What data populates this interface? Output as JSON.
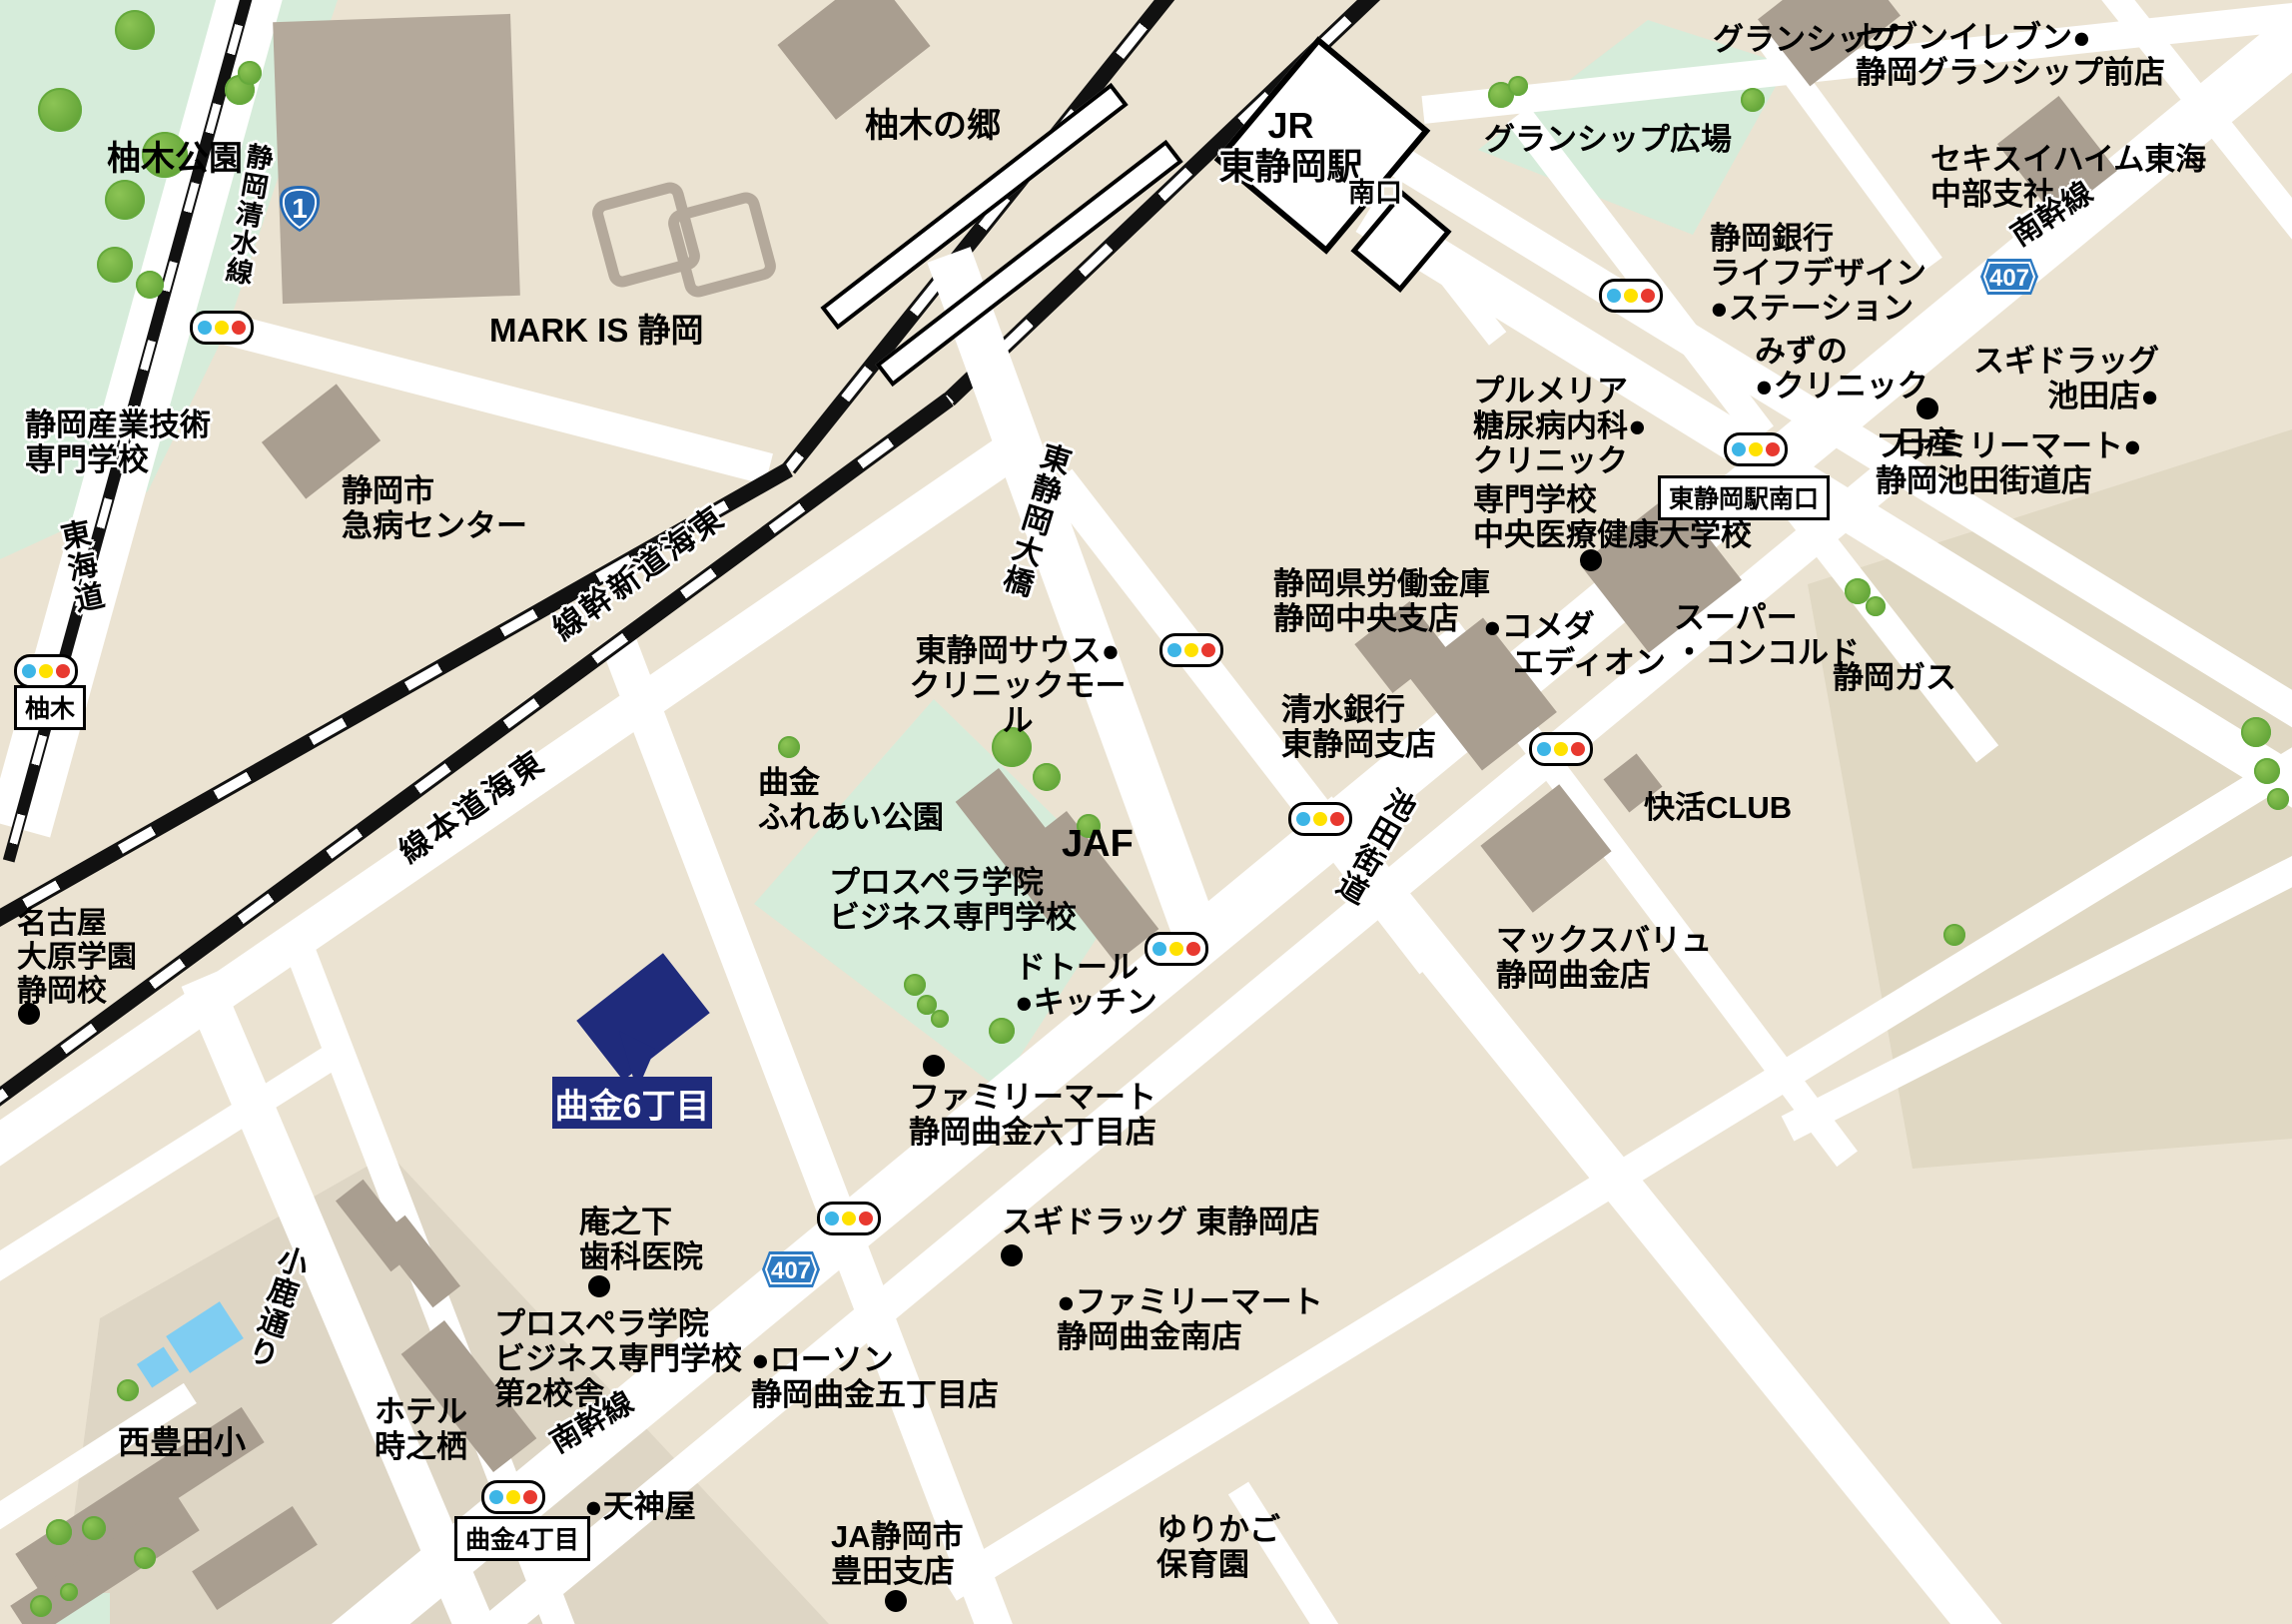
{
  "map_title": "東静岡駅周辺アクセスマップ",
  "colors": {
    "background": "#ebe3d2",
    "road": "#ffffff",
    "rail": "#111111",
    "park": "#d6ecda",
    "school_block": "#ded6c5",
    "gas_block": "#e0d8c3",
    "building": "#b4a99b",
    "building_dark": "#a99e90",
    "pool": "#7fcdf2",
    "highlight_navy": "#1f2b7c",
    "badge_blue": "#2569b4",
    "badge_blue_407": "#2d7ac2",
    "signal_blue": "#3db5e6",
    "signal_yellow": "#ffe100",
    "signal_red": "#e8392f"
  },
  "labels": {
    "route1": "1",
    "route407": "407",
    "yunoki_park": "柚木公園",
    "shimizu_line": "静岡清水線",
    "sangyo_tech": "静岡産業技術\n専門学校",
    "tokaido": "東海道",
    "yunoki_box": "柚木",
    "mark_is": "MARK IS 静岡",
    "kyubyo_center": "静岡市\n急病センター",
    "yunokinosato": "柚木の郷",
    "jr_station": "JR\n東静岡駅",
    "minamiguchi": "南口",
    "granship": "グランシップ",
    "seven_eleven": "セブンイレブン●\n静岡グランシップ前店",
    "granship_plaza": "グランシップ広場",
    "sekisui_heim": "セキスイハイム東海\n中部支社",
    "nankansen_top": "南幹線",
    "shizuoka_bank": "静岡銀行\nライフデザイン\n●ステーション",
    "sugi_ikeda": "スギドラッグ\n池田店●",
    "mizuno_clinic": "みずの\n●クリニック",
    "nissan": "日産",
    "famima_ikeda": "ファミリーマート●\n静岡池田街道店",
    "plumeria": "プルメリア\n糖尿病内科●\nクリニック",
    "chuo_medical": "専門学校\n中央医療健康大学校",
    "rokin": "静岡県労働金庫\n静岡中央支店",
    "komeda": "●コメダ",
    "station_south_box": "東静岡駅南口",
    "ohashi": "東静岡大橋",
    "tokaido_shinkansen": "東海道新幹線",
    "tokaido_shinkansen_display": "線幹新道海東",
    "tokaido_honsen": "東海道本線",
    "tokaido_honsen_display": "線本道海東",
    "south_clinic_mall": "東静岡サウス●\nクリニックモール",
    "shimizu_bank": "清水銀行\n東静岡支店",
    "edion": "エディオン",
    "concord": "スーパー\n・コンコルド",
    "shizuoka_gas": "静岡ガス",
    "magarikane_park": "曲金\nふれあい公園",
    "jaf": "JAF",
    "prospera": "プロスペラ学院\nビジネス専門学校",
    "doutor": "ドトール\n●キッチン",
    "kaikatsu_club": "快活CLUB",
    "ikeda_kaido": "池田街道",
    "maxvalu": "マックスバリュ\n静岡曲金店",
    "nagoya_ohara": "名古屋\n大原学園\n静岡校",
    "flag_label": "曲金6丁目",
    "annoshita": "庵之下\n歯科医院",
    "prospera2": "プロスペラ学院\nビジネス専門学校\n第2校舎",
    "hotel_tokinosumika": "ホテル\n時之栖",
    "nishitoyoda": "西豊田小",
    "kojika_dori": "小鹿通り",
    "nankansen_bottom": "南幹線",
    "magarikane4_box": "曲金4丁目",
    "tenjinya": "●天神屋",
    "lawson": "●ローソン\n静岡曲金五丁目店",
    "famima_6chome": "ファミリーマート\n静岡曲金六丁目店",
    "sugi_higashi": "スギドラッグ 東静岡店",
    "famima_south": "●ファミリーマート\n静岡曲金南店",
    "ja_toyoda": "JA静岡市\n豊田支店",
    "yurikago": "ゆりかご\n保育園"
  }
}
